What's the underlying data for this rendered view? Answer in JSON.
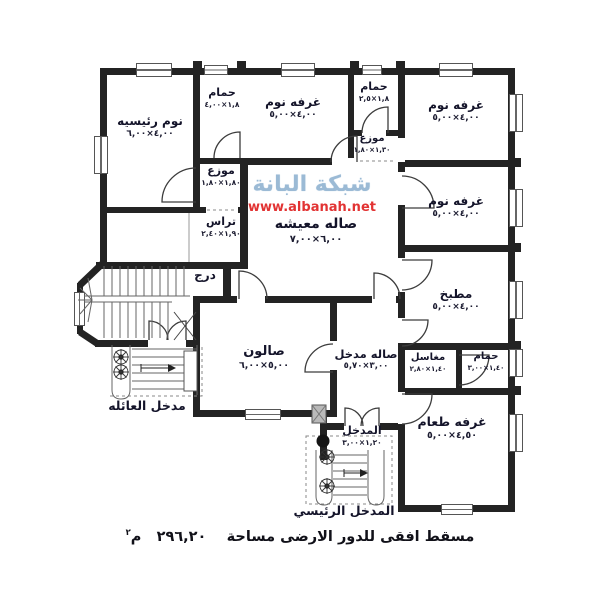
{
  "colors": {
    "wall": "#232323",
    "watermark_blue": "#9bbad5",
    "watermark_red": "#e23333",
    "text": "#14142a"
  },
  "watermark": {
    "brand": "شبكة البانة",
    "url": "www.albanah.net"
  },
  "caption": {
    "text": "مسقط افقى للدور الارضى مساحة",
    "value": "٢٩٦,٢٠",
    "unit": "م",
    "sup": "٢"
  },
  "rooms": [
    {
      "name": "نوم رئيسيه",
      "dims": "٤,٠٠×٦,٠٠"
    },
    {
      "name": "حمام",
      "dims": "١,٨×٤,٠٠"
    },
    {
      "name": "غرفه نوم",
      "dims": "٤,٠٠×٥,٠٠"
    },
    {
      "name": "حمام",
      "dims": "١,٨×٢,٥"
    },
    {
      "name": "غرفه نوم",
      "dims": "٤,٠٠×٥,٠٠"
    },
    {
      "name": "موزع",
      "dims": "١,٣٠×١,٨٠"
    },
    {
      "name": "موزع",
      "dims": "١,٨٠×١,٨٠"
    },
    {
      "name": "غرفه نوم",
      "dims": "٤,٠٠×٥,٠٠"
    },
    {
      "name": "تراس",
      "dims": "١,٩٠×٢,٤٠"
    },
    {
      "name": "صاله معيشه",
      "dims": "٦,٠٠×٧,٠٠"
    },
    {
      "name": "درج",
      "dims": ""
    },
    {
      "name": "مطبخ",
      "dims": "٤,٠٠×٥,٠٠"
    },
    {
      "name": "صالون",
      "dims": "٥,٠٠×٦,٠٠"
    },
    {
      "name": "صاله مدخل",
      "dims": "٣,٠٠×٥,٧٠"
    },
    {
      "name": "مغاسل",
      "dims": "١,٤٠×٢,٨٠"
    },
    {
      "name": "حمام",
      "dims": "١,٤٠×٣,٠٠"
    },
    {
      "name": "غرفه طعام",
      "dims": "٤,٥٠×٥,٠٠"
    },
    {
      "name": "المدخل",
      "dims": "١,٢٠×٣,٠٠"
    }
  ],
  "entrances": {
    "family": "مدخل العائله",
    "main": "المدخل الرئيسي"
  }
}
